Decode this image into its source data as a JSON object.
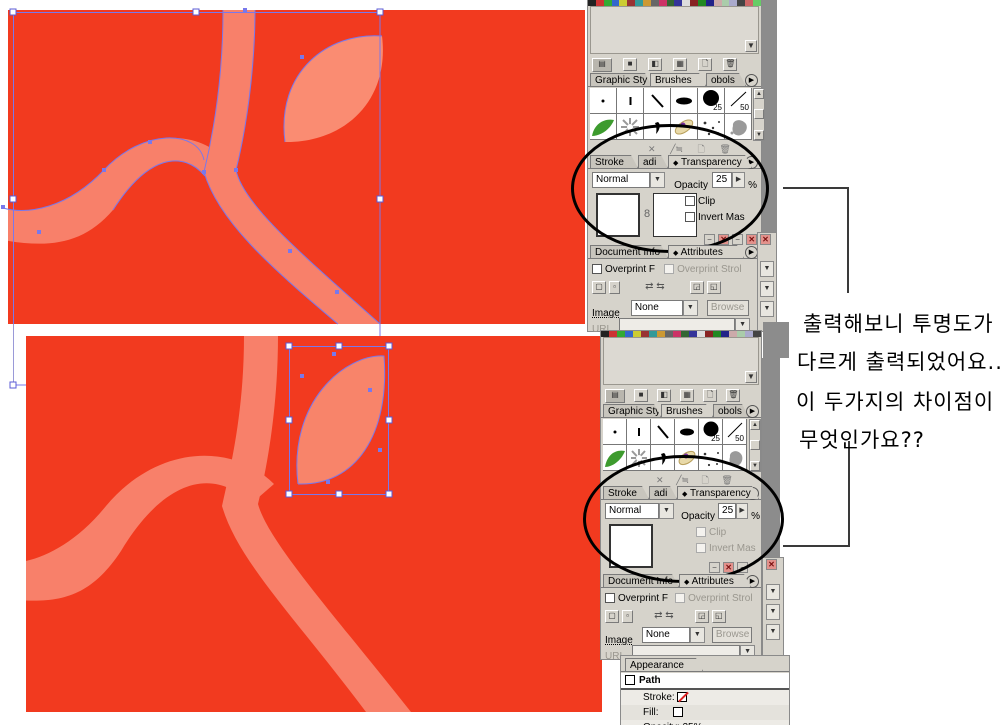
{
  "colors": {
    "canvas_red": "#F23A1F",
    "branch_salmon": "#F8806A",
    "leaf_salmon": "#FA8C72",
    "selection_blue": "#7878EC",
    "palette_gray": "#D6D3CB",
    "desktop_gray": "#8C8C8C"
  },
  "note": {
    "line1": "출력해보니 투명도가",
    "line2": "다르게 출력되었어요..",
    "line3": "이 두가지의 차이점이",
    "line4": "무엇인가요??"
  },
  "shared": {
    "panel_tabs": {
      "graphic_styles": "Graphic Sty",
      "brushes": "Brushes",
      "symbols": "obols"
    },
    "brushes": {
      "calligraphic_25": "25",
      "calligraphic_50": "50"
    },
    "transparency": {
      "tab_stroke": "Stroke",
      "tab_gradient": "adi",
      "marker": "◆",
      "tab": "Transparency",
      "mode": "Normal",
      "opacity_label": "Opacity",
      "opacity_value": "25",
      "percent_sign": "%",
      "clip": "Clip",
      "invert_mask": "Invert Mas"
    },
    "attributes": {
      "tab_document_info": "Document Info",
      "marker": "◆",
      "tab": "Attributes",
      "overprint_fill": "Overprint F",
      "overprint_stroke": "Overprint Strol",
      "image": "Image",
      "image_value": "None",
      "browse": "Browse",
      "url": "URL"
    }
  },
  "appearance": {
    "tab": "Appearance",
    "path": "Path",
    "stroke": "Stroke:",
    "fill": "Fill:",
    "opacity": "Opacity: 25%"
  },
  "icons": {
    "panel_menu": "▶",
    "scroll_up": "▲",
    "scroll_down": "▼",
    "dropdown_arrow": "▼",
    "spinner_arrow": "▶",
    "link_glyph": "8",
    "minimize": "−",
    "close": "✕",
    "swap_arrows": "⇄ ⇆",
    "delete_x": "✕"
  }
}
